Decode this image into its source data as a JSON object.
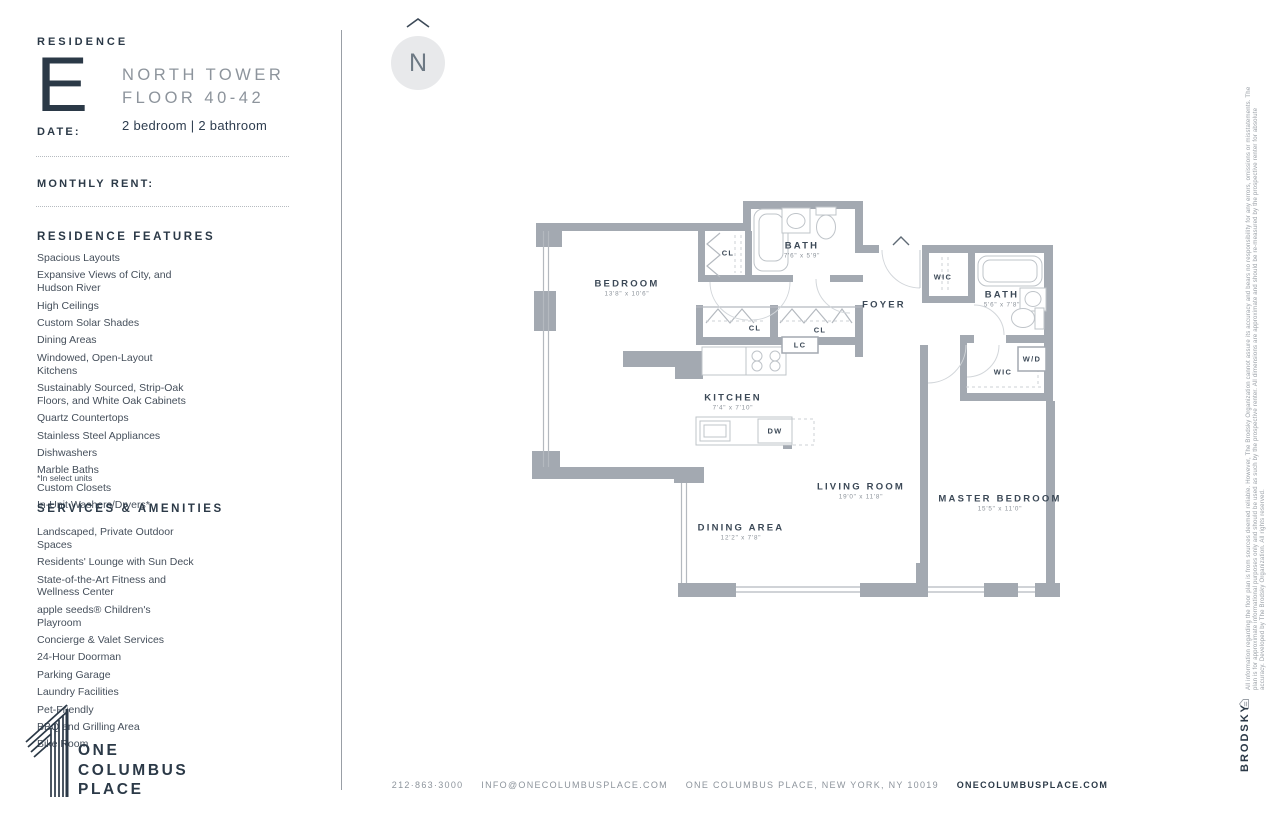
{
  "header": {
    "residence_label": "RESIDENCE",
    "residence_letter": "E",
    "tower": "NORTH TOWER",
    "floor": "FLOOR 40-42",
    "bed_bath": "2 bedroom  |  2 bathroom",
    "date_label": "DATE:",
    "rent_label": "MONTHLY RENT:"
  },
  "features": {
    "title": "RESIDENCE FEATURES",
    "items": [
      "Spacious Layouts",
      "Expansive Views of City, and Hudson River",
      "High Ceilings",
      "Custom Solar Shades",
      "Dining Areas",
      "Windowed, Open-Layout Kitchens",
      "Sustainably Sourced, Strip-Oak Floors, and White Oak Cabinets",
      "Quartz Countertops",
      "Stainless Steel Appliances",
      "Dishwashers",
      "Marble Baths",
      "Custom Closets",
      "In-Unit Washers/Dryers*"
    ],
    "footnote": "*In select units"
  },
  "amenities": {
    "title": "SERVICES & AMENITIES",
    "items": [
      "Landscaped, Private Outdoor Spaces",
      "Residents' Lounge with Sun Deck",
      "State-of-the-Art Fitness and Wellness Center",
      "apple seeds® Children's Playroom",
      "Concierge & Valet Services",
      "24-Hour Doorman",
      "Parking Garage",
      "Laundry Facilities",
      "Pet-Friendly",
      "BBQ and Grilling Area",
      "Bike Room"
    ]
  },
  "logo": {
    "line1": "ONE",
    "line2": "COLUMBUS",
    "line3": "PLACE"
  },
  "compass": {
    "letter": "N"
  },
  "floorplan": {
    "bedroom": {
      "name": "BEDROOM",
      "dims": "13'8\" x 10'6\""
    },
    "bath1": {
      "name": "BATH",
      "dims": "7'6\" x 5'9\""
    },
    "bath2": {
      "name": "BATH",
      "dims": "5'6\" x 7'8\""
    },
    "kitchen": {
      "name": "KITCHEN",
      "dims": "7'4\" x 7'10\""
    },
    "living": {
      "name": "LIVING ROOM",
      "dims": "19'0\" x 11'8\""
    },
    "dining": {
      "name": "DINING AREA",
      "dims": "12'2\" x 7'8\""
    },
    "master": {
      "name": "MASTER BEDROOM",
      "dims": "15'5\" x 11'0\""
    },
    "foyer": "FOYER",
    "wic": "WIC",
    "cl": "CL",
    "lc": "LC",
    "wd": "W/D",
    "dw": "DW"
  },
  "footer": {
    "phone": "212·863·3000",
    "email": "INFO@ONECOLUMBUSPLACE.COM",
    "address": "ONE COLUMBUS PLACE, NEW YORK, NY 10019",
    "website": "ONECOLUMBUSPLACE.COM"
  },
  "legal": {
    "disclaimer": "All information regarding the floor plan is from sources deemed reliable. However, The Brodsky Organization cannot assure its accuracy and bears no responsibility for any errors, omissions or misstatements. The plan is for approximate informational purposes only and should be used as such by the prospective renter. All dimensions are approximate and should be re-measured by the prospective renter for absolute accuracy. Developed by The Brodsky Organization. All rights reserved.",
    "brand": "BRODSKY"
  }
}
